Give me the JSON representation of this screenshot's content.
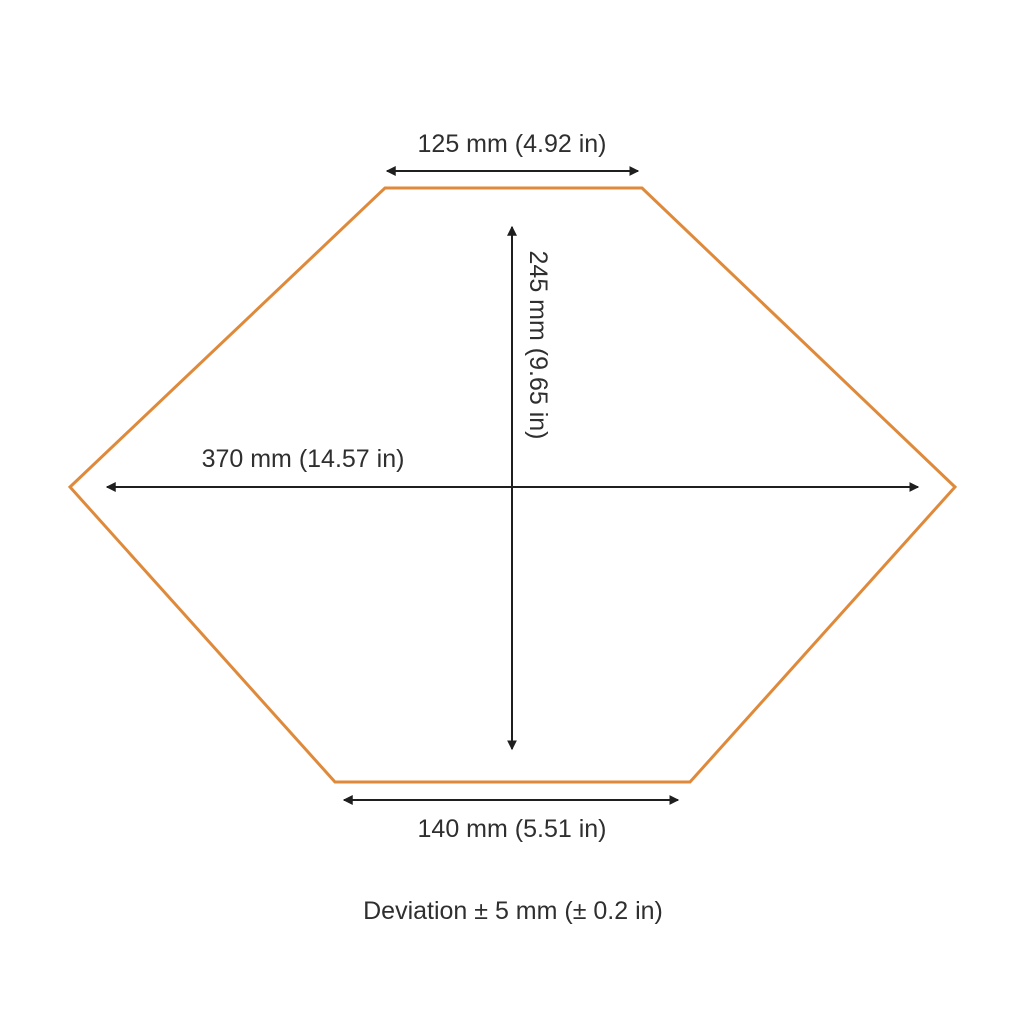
{
  "diagram": {
    "shape": "hexagon",
    "colors": {
      "outline": "#DF8A3B",
      "arrow": "#1F1F1F",
      "text": "#2F2F2F",
      "background": "#FFFFFF"
    },
    "dimensions": {
      "top_width": "125 mm (4.92 in)",
      "height": "245 mm (9.65 in)",
      "total_width": "370 mm (14.57 in)",
      "bottom_width": "140 mm (5.51 in)"
    },
    "deviation_note": "Deviation ± 5 mm (± 0.2 in)"
  }
}
